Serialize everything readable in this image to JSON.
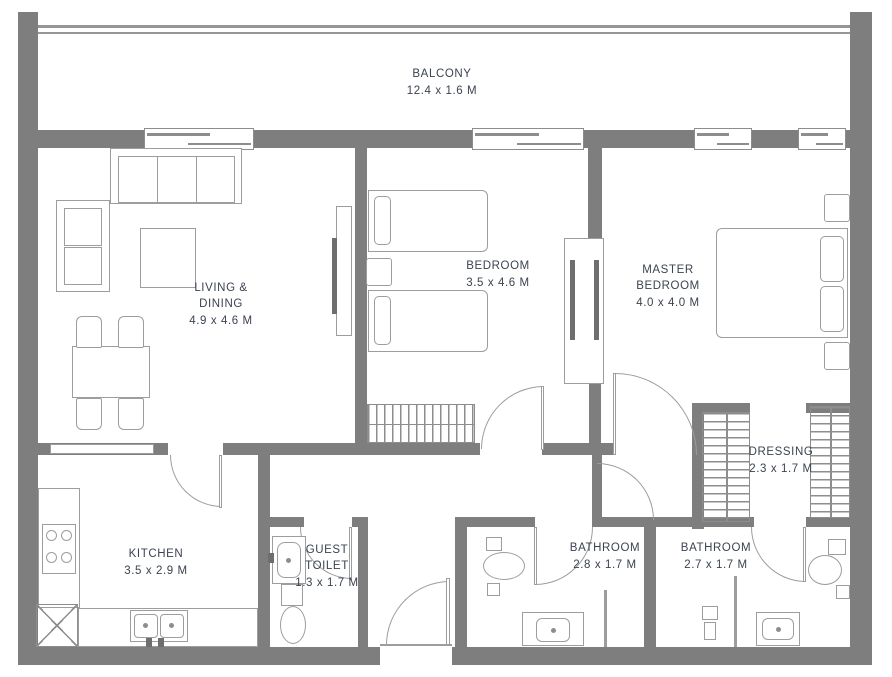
{
  "meta": {
    "canvas_width": 892,
    "canvas_height": 677,
    "type": "apartment-floor-plan"
  },
  "colors": {
    "wall": "#7e7e7e",
    "furniture_line": "#9d9d9d",
    "text": "#3b4350",
    "background": "#ffffff"
  },
  "rooms": {
    "balcony": {
      "name": "BALCONY",
      "dims": "12.4 x 1.6 M"
    },
    "living_dining": {
      "name": "LIVING &\nDINING",
      "dims": "4.9 x 4.6 M"
    },
    "bedroom": {
      "name": "BEDROOM",
      "dims": "3.5 x 4.6 M"
    },
    "master_bedroom": {
      "name": "MASTER\nBEDROOM",
      "dims": "4.0 x 4.0 M"
    },
    "dressing": {
      "name": "DRESSING",
      "dims": "2.3 x 1.7 M"
    },
    "kitchen": {
      "name": "KITCHEN",
      "dims": "3.5 x 2.9 M"
    },
    "guest_toilet": {
      "name": "GUEST\nTOILET",
      "dims": "1.3 x 1.7 M"
    },
    "bathroom_1": {
      "name": "BATHROOM",
      "dims": "2.8 x 1.7 M"
    },
    "bathroom_2": {
      "name": "BATHROOM",
      "dims": "2.7 x 1.7 M"
    }
  }
}
